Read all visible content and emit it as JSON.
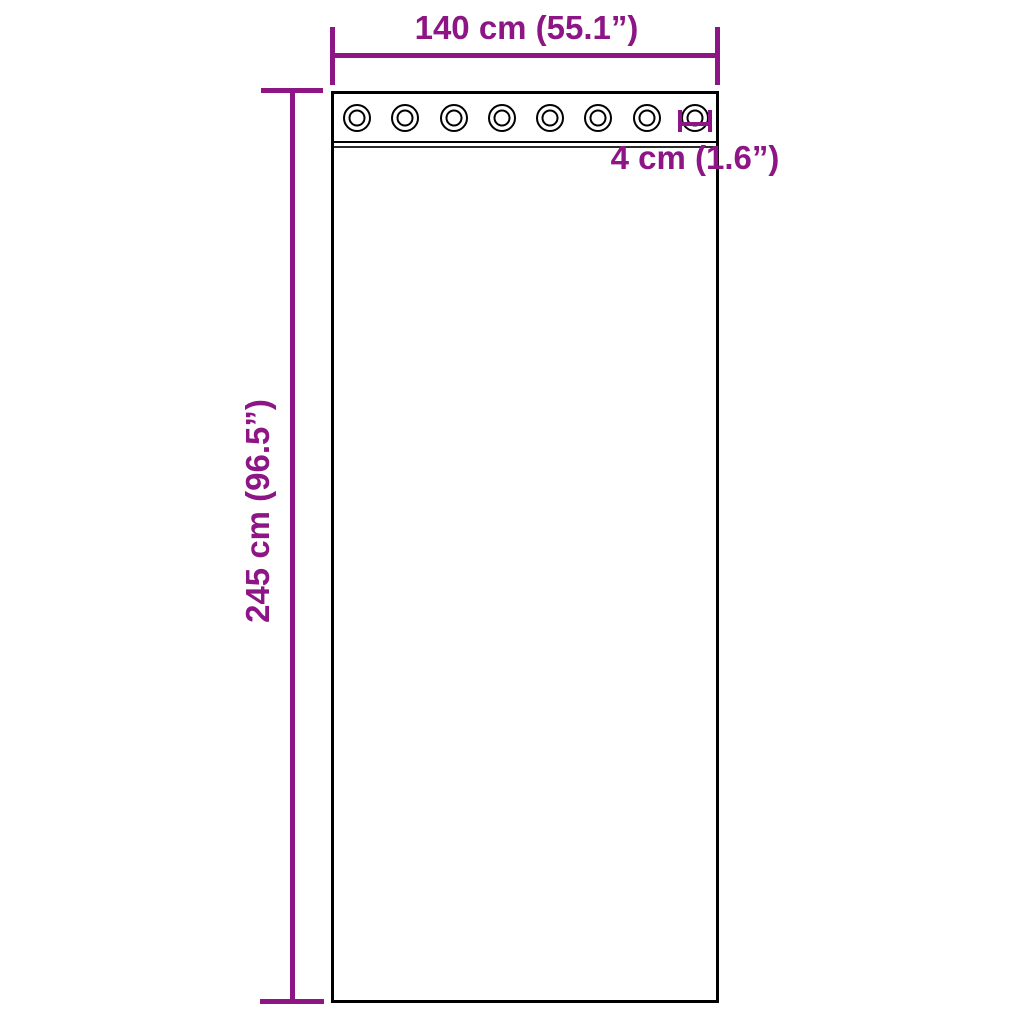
{
  "page": {
    "background_color": "#ffffff"
  },
  "diagram": {
    "subject": "curtain-panel-with-grommets",
    "accent_color": "#8D1585",
    "outline_color": "#000000",
    "grommet_count": 8,
    "dimensions": {
      "width_label": "140 cm (55.1”)",
      "height_label": "245 cm (96.5”)",
      "grommet_label": "4 cm (1.6”)"
    }
  }
}
